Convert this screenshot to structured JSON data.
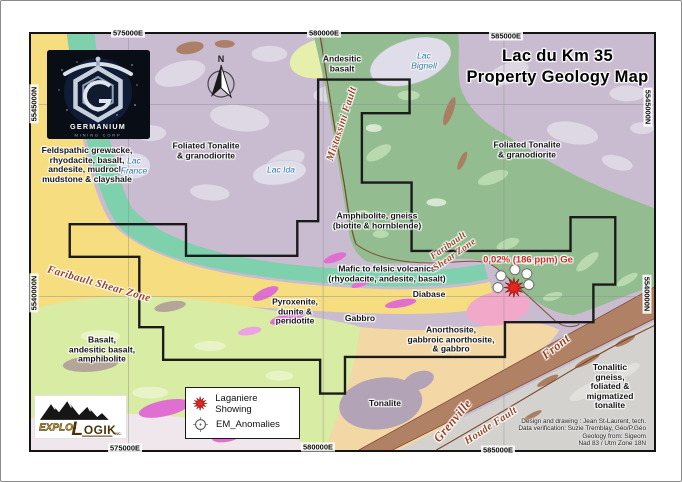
{
  "map": {
    "title": {
      "line1": "Lac du Km 35",
      "line2": "Property Geology Map"
    },
    "north_label": "N",
    "annotation_ge": "0,02% (186 ppm) Ge",
    "unit_labels": {
      "feldspathic": "Feldspathic grewacke,\nrhyodacite, basalt,\nandesite, mudrock,\nmudstone & clayshale",
      "foliated_left": "Foliated Tonalite\n& granodiorite",
      "foliated_right": "Foliated Tonalite\n& granodiorite",
      "andesitic": "Andesitic\nbasalt",
      "amphibolite": "Amphibolite, gneiss\n(biotite & hornblende)",
      "mafic": "Mafic to felsic volcanics\n(rhyodacite, andesite, basalt)",
      "diabase": "Diabase",
      "gabbro": "Gabbro",
      "pyroxenite": "Pyroxenite,\ndunite &\nperidotite",
      "basalt": "Basalt,\nandesitic basalt,\namphibolite",
      "anorthosite": "Anorthosite,\ngabbroic anorthosite,\n& gabbro",
      "tonalite": "Tonalite",
      "tonalitic_gneiss": "Tonalitic gneiss,\nfoliated & migmatized\ntonalite"
    },
    "fault_labels": {
      "mistassini": "Mistassini Fault",
      "faribault_left": "Faribault Shear Zone",
      "faribault_right": "Faribault\nShear Zone",
      "grenville": "Grenville",
      "front": "Front",
      "houde": "Houde Fault"
    },
    "lake_labels": {
      "france": "Lac\nFrance",
      "ida": "Lac Ida",
      "bignell": "Lac\nBignell"
    }
  },
  "grid": {
    "top": [
      "575000E",
      "580000E",
      "585000E"
    ],
    "bottom": [
      "575000E",
      "580000E",
      "585000E"
    ],
    "left": [
      "5545000N",
      "5540000N"
    ],
    "right": [
      "5545000N",
      "5540000N"
    ]
  },
  "legend": {
    "items": [
      {
        "icon": "showing-star",
        "label": "Laganiere Showing"
      },
      {
        "icon": "em-anomaly",
        "label": "EM_Anomalies"
      }
    ]
  },
  "credits": [
    "Design and drawing : Jean St-Laurent, tech.",
    "Data verification: Suzie Tremblay, Géo/P.Géo",
    "Geology from: Sigeom",
    "Nad 83 / Utm Zone 18N"
  ],
  "logos": {
    "germanium": {
      "name": "GERMANIUM",
      "tagline": "MINING CORP"
    },
    "explologik": {
      "prefix": "EXPLO-",
      "l": "L",
      "rest": "OGIK",
      "suffix": "INC."
    }
  },
  "colors": {
    "claim_boundary": "#1b1b1b",
    "showing_star": "#e8241c",
    "fault_label": "#9a4526",
    "lake_label": "#2e77ad",
    "annotation": "#cf2b20",
    "title": "#000000",
    "units": {
      "foliated_tonalite_purple": "#c9bcd0",
      "amphibolite_gneiss_green": "#93bc90",
      "mafic_volcanics_teal": "#7fd0ad",
      "shear_zone_yellow": "#f6dd80",
      "basalt_light_green": "#d9eca4",
      "andesitic_basalt": "#e7efad",
      "anorthosite_peach": "#f3d8a6",
      "tonalitic_gneiss_gray": "#d4d2cf",
      "grenville_band_brown": "#b08164",
      "pink_unit": "#f2a9c9",
      "pyroxenite_magenta": "#e06fd2",
      "tonalite_gray_purple": "#b2a4b6",
      "lake": "#dfdde9"
    }
  }
}
